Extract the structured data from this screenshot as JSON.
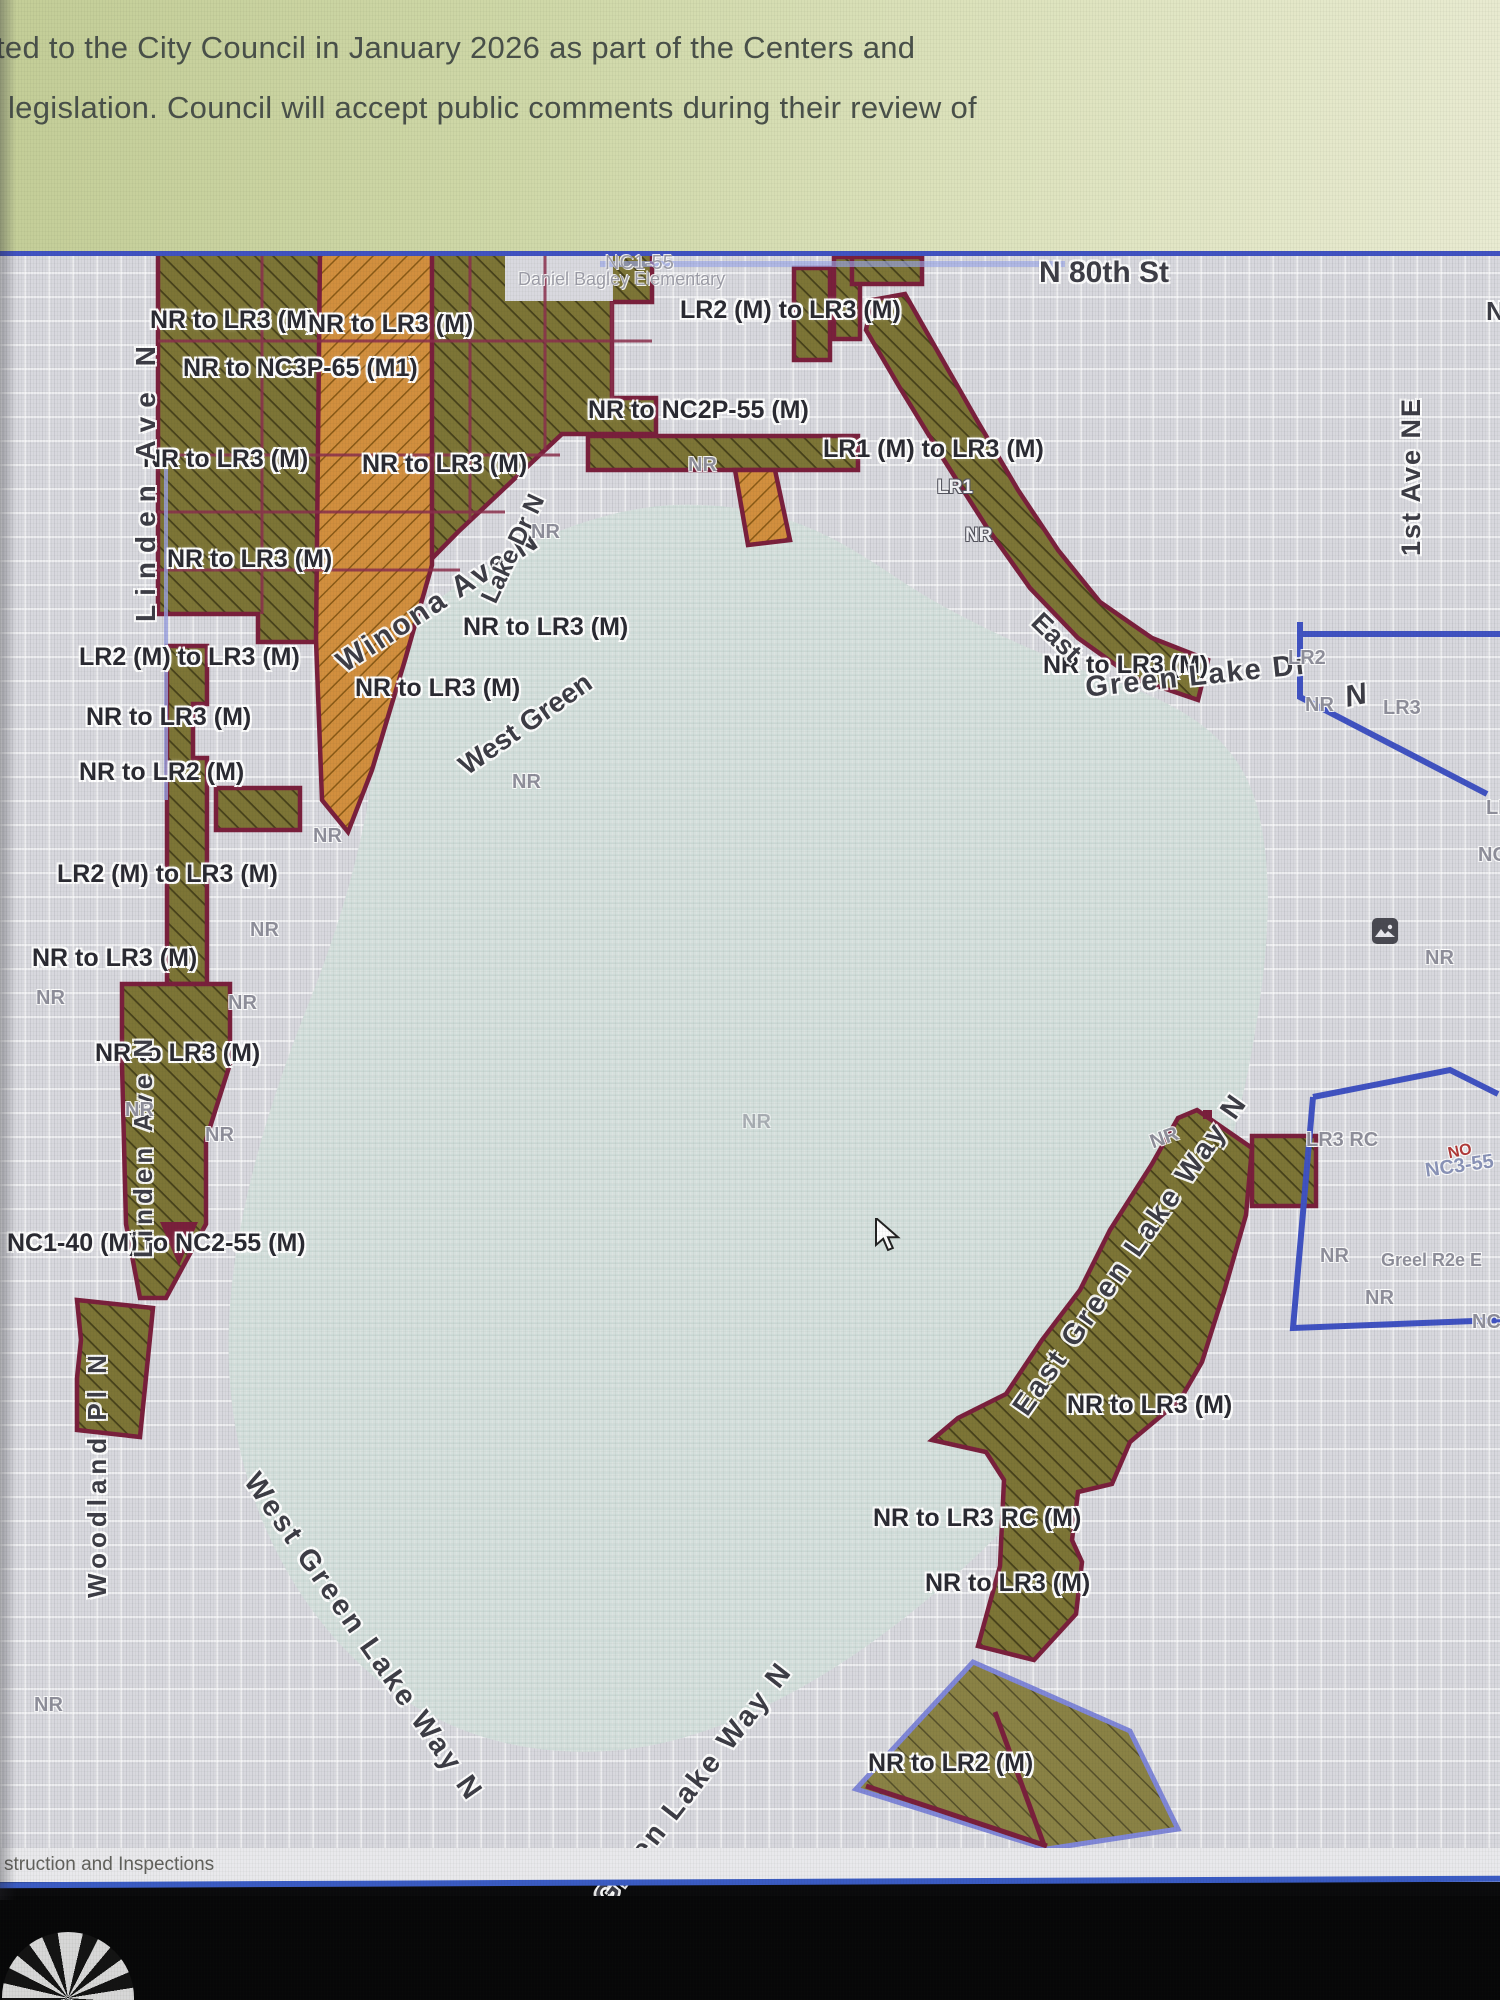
{
  "banner": {
    "line1": "ted to the City Council in January 2026 as part of the Centers and",
    "line2": "legislation. Council will accept public comments during their review of"
  },
  "footer": {
    "partial_text": "struction and Inspections"
  },
  "map": {
    "rezones": [
      "NR to LR3 (M)",
      "NR to LR3 (M)",
      "NR to NC3P-65 (M1)",
      "LR2 (M) to LR3 (M)",
      "NR to NC2P-55 (M)",
      "LR1 (M) to LR3 (M)",
      "NR to LR3 (M)",
      "NR to LR3 (M)",
      "NR to LR3 (M)",
      "NR to LR3 (M)",
      "LR2 (M) to LR3 (M)",
      "NR to LR3 (M)",
      "NR to LR3 (M)",
      "NR to LR2 (M)",
      "NR to LR3 (M)",
      "LR2 (M) to LR3 (M)",
      "NR to LR3 (M)",
      "NR to LR3 (M)",
      "NC1-40 (M) to NC2-55 (M)",
      "NR to LR3 (M)",
      "NR to LR3 RC (M)",
      "NR to LR3 (M)",
      "NR to LR2 (M)"
    ],
    "streets": {
      "n_80th_st": "N 80th St",
      "first_ave_ne": "1st Ave NE",
      "linden_ave_n": "Linden Ave N",
      "woodland_pl_n": "Woodland Pl N",
      "winona_ave_n": "Winona Ave N",
      "west_green_fragment": "West Green",
      "lake_dr_n_fragment": "Lake Dr N",
      "east_fragment": "East",
      "green_lake_dr": "Green Lake Dr",
      "n_letter": "N",
      "east_green_lake_way_n": "East Green Lake Way N",
      "west_green_lake_way_n": "West Green Lake Way N",
      "t_green_lake_way_n": "t Green Lake Way N"
    },
    "places": {
      "school": "Daniel Bagley Elementary",
      "school_zone": "NC1-55"
    },
    "zone_codes": {
      "nr": "NR",
      "lr1": "LR1",
      "lr2": "LR2",
      "lr3": "LR3",
      "lr": "LR",
      "nc": "NC",
      "lr3_rc": "LR3 RC",
      "nc3_55": "NC3-55",
      "overlap_fragment": "Greel R2e E",
      "red_mark": "NO"
    },
    "colors": {
      "olive_zone": "#7d7536",
      "orange_zone": "#d28f3e",
      "zone_border_maroon": "#7a1f3c",
      "boundary_blue": "#4052c2",
      "zone_border_periwinkle": "#8087d8",
      "lake": "#d5e0dd",
      "banner_green": "#cfd8a8"
    }
  }
}
